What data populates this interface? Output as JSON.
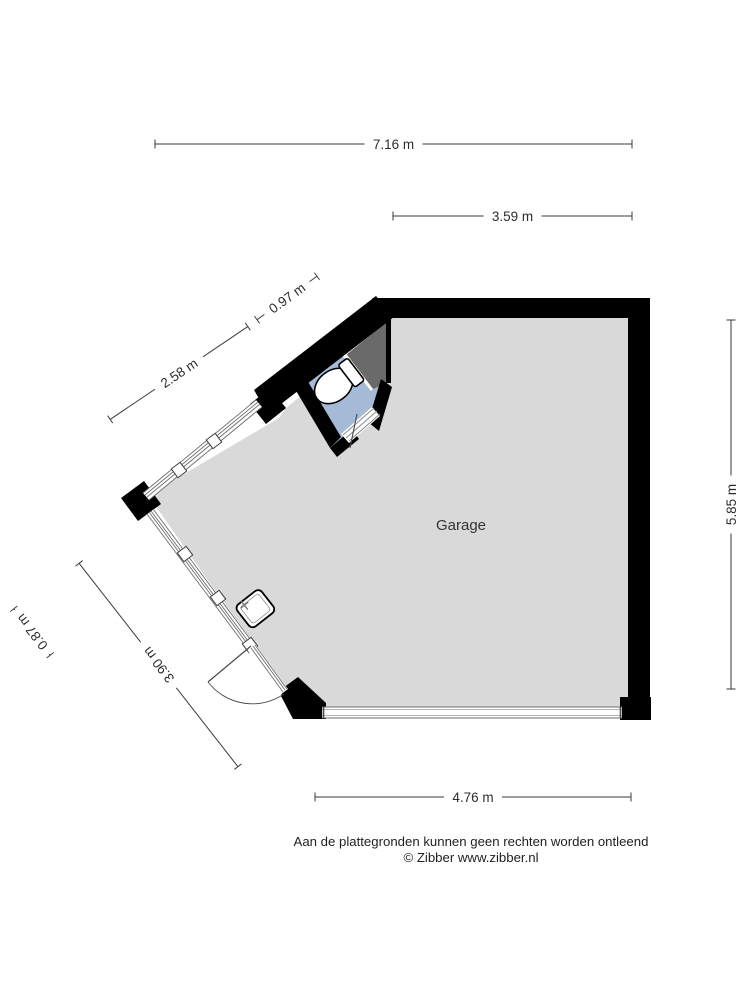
{
  "room": {
    "label": "Garage"
  },
  "dimensions": {
    "top": "7.16 m",
    "top_right": "3.59 m",
    "upper_diag_short": "0.97 m",
    "upper_diag_long": "2.58 m",
    "right": "5.85 m",
    "bottom": "4.76 m",
    "lower_diag_long": "3.90 m",
    "lower_diag_short": "0.87 m"
  },
  "footer": {
    "disclaimer": "Aan de plattegronden kunnen geen rechten worden ontleend",
    "copyright": "© Zibber www.zibber.nl"
  },
  "colors": {
    "floor": "#d9d9d9",
    "toilet_floor": "#a4bad7",
    "void_area": "#6a6a6a",
    "wall": "#000000",
    "dimension": "#3a3a3a"
  }
}
